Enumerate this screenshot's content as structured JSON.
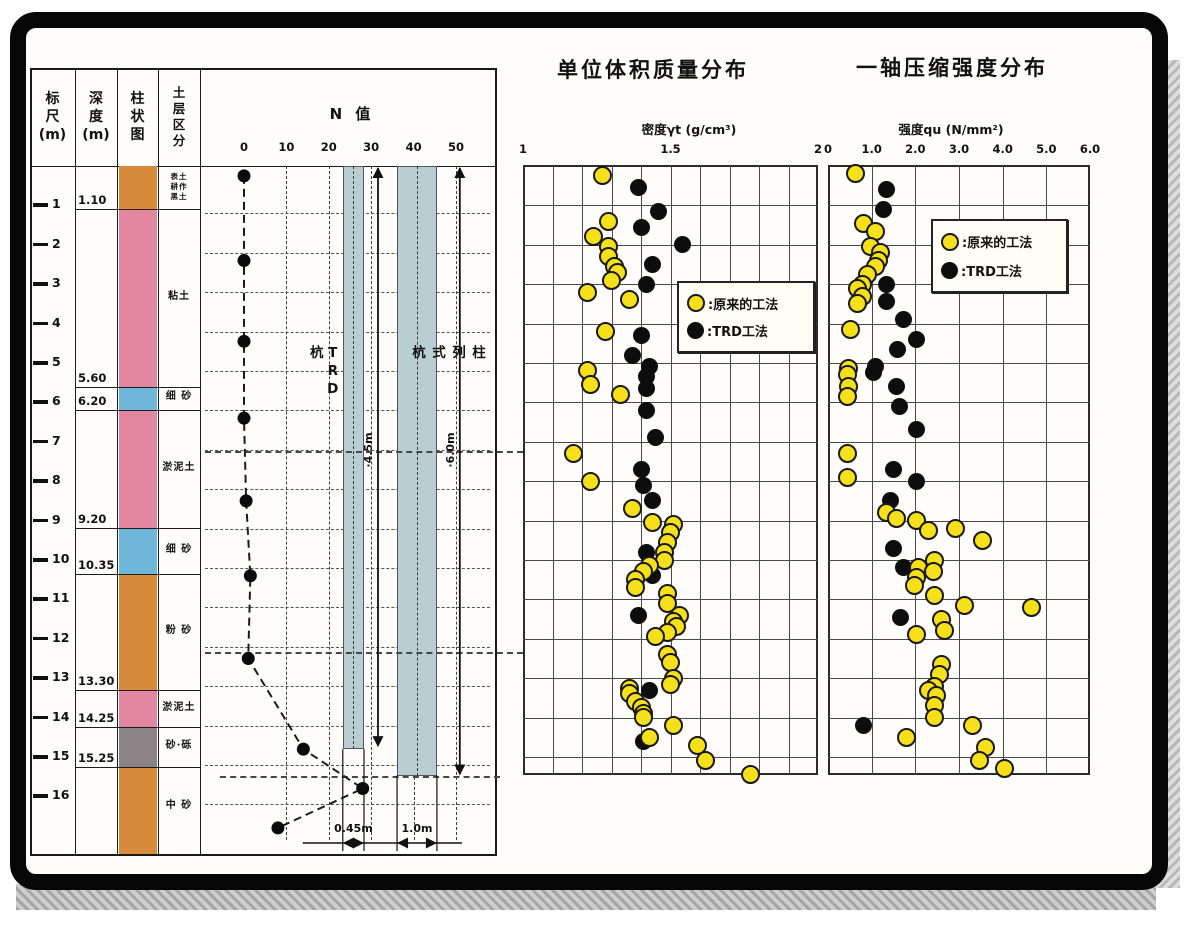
{
  "colors": {
    "bar_fill": "#b9ced3",
    "soil_orange": "#d78c3c",
    "soil_pink": "#e287a0",
    "soil_blue": "#6fb7da",
    "soil_gray": "#8b8486",
    "dot_yellow": "#f6e019",
    "dot_black": "#0d0d0d",
    "frame": "#070707"
  },
  "borehole": {
    "headers": [
      {
        "label": "标\n尺\n(m)"
      },
      {
        "label": "深\n度\n(m)"
      },
      {
        "label": "柱\n状\n图"
      },
      {
        "label": "土\n层\n区\n分"
      }
    ],
    "ruler_max": 16,
    "boundaries": [
      {
        "depth": 1.1,
        "label": "1.10"
      },
      {
        "depth": 5.6,
        "label": "5.60"
      },
      {
        "depth": 6.2,
        "label": "6.20"
      },
      {
        "depth": 9.2,
        "label": "9.20"
      },
      {
        "depth": 10.35,
        "label": "10.35"
      },
      {
        "depth": 13.3,
        "label": "13.30"
      },
      {
        "depth": 14.25,
        "label": "14.25"
      },
      {
        "depth": 15.25,
        "label": "15.25"
      }
    ],
    "layers": [
      {
        "from": 0,
        "to": 1.1,
        "color_key": "soil_orange",
        "label": "表土\n耕作\n黑土",
        "small": true
      },
      {
        "from": 1.1,
        "to": 5.6,
        "color_key": "soil_pink",
        "label": "粘土",
        "small": false
      },
      {
        "from": 5.6,
        "to": 6.2,
        "color_key": "soil_blue",
        "label": "细 砂",
        "small": false
      },
      {
        "from": 6.2,
        "to": 9.2,
        "color_key": "soil_pink",
        "label": "淤泥土",
        "small": false
      },
      {
        "from": 9.2,
        "to": 10.35,
        "color_key": "soil_blue",
        "label": "细 砂",
        "small": false
      },
      {
        "from": 10.35,
        "to": 13.3,
        "color_key": "soil_orange",
        "label": "粉 砂",
        "small": false
      },
      {
        "from": 13.3,
        "to": 14.25,
        "color_key": "soil_pink",
        "label": "淤泥土",
        "small": false
      },
      {
        "from": 14.25,
        "to": 15.25,
        "color_key": "soil_gray",
        "label": "砂·砾",
        "small": false
      },
      {
        "from": 15.25,
        "to": 17.45,
        "color_key": "soil_orange",
        "label": "中 砂",
        "small": false
      }
    ]
  },
  "n_chart": {
    "title": "N 值",
    "ticks": [
      0,
      10,
      20,
      30,
      40,
      50
    ],
    "bars": [
      {
        "label": "TRD杭",
        "from_n": 23.3,
        "to_n": 28.3,
        "bottom_depth": 14.8,
        "label_pos": "left"
      },
      {
        "label": "柱列式杭",
        "from_n": 36.1,
        "to_n": 45.5,
        "bottom_depth": 15.47,
        "label_pos": "inside"
      }
    ],
    "arrows": [
      {
        "n": 31.6,
        "bottom_depth": 14.75,
        "label": "·4.5m"
      },
      {
        "n": 50.9,
        "bottom_depth": 15.47,
        "label": "·6.0m"
      }
    ],
    "dims": [
      {
        "label": "0.45m",
        "from_n": 23.3,
        "to_n": 28.3,
        "ext_depth": 14.8
      },
      {
        "label": "1.0m",
        "from_n": 36.1,
        "to_n": 45.5,
        "ext_depth": 15.47
      }
    ],
    "connector_depths": [
      7.2,
      12.3
    ],
    "bottom_connector_depth": 15.47
  },
  "chart_data": {
    "n_curve": {
      "type": "line",
      "xlabel": "N 值",
      "x_ticks": [
        0,
        10,
        20,
        30,
        40,
        50
      ],
      "points": [
        [
          0.25,
          0
        ],
        [
          2.4,
          0
        ],
        [
          4.45,
          0
        ],
        [
          6.4,
          0
        ],
        [
          8.5,
          0.5
        ],
        [
          10.4,
          1.5
        ],
        [
          12.5,
          1.0
        ],
        [
          14.8,
          14
        ],
        [
          15.8,
          28
        ],
        [
          16.8,
          8
        ]
      ]
    },
    "scatter_charts": [
      {
        "type": "scatter",
        "title": "单位体积质量分布",
        "axis_label": "密度γt (g/cm³)",
        "range": [
          1,
          2
        ],
        "minor_step": 0.1,
        "depth_range": [
          0,
          15.5
        ],
        "ticks": [
          {
            "v": 1,
            "t": "1"
          },
          {
            "v": 1.5,
            "t": "1.5"
          },
          {
            "v": 2,
            "t": "2"
          }
        ],
        "legend": [
          {
            "marker": "yellow",
            "label": ":原来的工法"
          },
          {
            "marker": "black",
            "label": ":TRD工法"
          }
        ],
        "series": [
          {
            "name": "TRD工法",
            "marker": "black",
            "points": [
              [
                0.55,
                1.39
              ],
              [
                1.15,
                1.46
              ],
              [
                1.55,
                1.4
              ],
              [
                2.0,
                1.54
              ],
              [
                2.5,
                1.44
              ],
              [
                3.0,
                1.42
              ],
              [
                4.3,
                1.4
              ],
              [
                4.8,
                1.37
              ],
              [
                5.1,
                1.43
              ],
              [
                5.35,
                1.42
              ],
              [
                5.65,
                1.42
              ],
              [
                6.2,
                1.42
              ],
              [
                6.9,
                1.45
              ],
              [
                7.7,
                1.4
              ],
              [
                8.1,
                1.41
              ],
              [
                8.5,
                1.44
              ],
              [
                9.8,
                1.42
              ],
              [
                10.4,
                1.44
              ],
              [
                11.4,
                1.39
              ],
              [
                13.3,
                1.43
              ],
              [
                14.6,
                1.41
              ]
            ]
          },
          {
            "name": "原来的工法",
            "marker": "yellow",
            "points": [
              [
                0.25,
                1.27
              ],
              [
                1.4,
                1.29
              ],
              [
                1.8,
                1.24
              ],
              [
                2.05,
                1.29
              ],
              [
                2.3,
                1.29
              ],
              [
                2.55,
                1.31
              ],
              [
                2.7,
                1.32
              ],
              [
                2.9,
                1.3
              ],
              [
                3.2,
                1.22
              ],
              [
                3.4,
                1.36
              ],
              [
                4.2,
                1.28
              ],
              [
                5.2,
                1.22
              ],
              [
                5.55,
                1.23
              ],
              [
                5.8,
                1.33
              ],
              [
                7.3,
                1.17
              ],
              [
                8.0,
                1.23
              ],
              [
                8.7,
                1.37
              ],
              [
                9.05,
                1.44
              ],
              [
                9.1,
                1.51
              ],
              [
                9.3,
                1.5
              ],
              [
                9.55,
                1.49
              ],
              [
                9.8,
                1.48
              ],
              [
                10.0,
                1.48
              ],
              [
                10.15,
                1.43
              ],
              [
                10.3,
                1.41
              ],
              [
                10.5,
                1.38
              ],
              [
                10.7,
                1.38
              ],
              [
                10.85,
                1.49
              ],
              [
                11.1,
                1.49
              ],
              [
                11.4,
                1.53
              ],
              [
                11.55,
                1.51
              ],
              [
                11.7,
                1.52
              ],
              [
                11.85,
                1.49
              ],
              [
                11.95,
                1.45
              ],
              [
                12.4,
                1.49
              ],
              [
                12.6,
                1.5
              ],
              [
                13.0,
                1.51
              ],
              [
                13.15,
                1.5
              ],
              [
                13.25,
                1.36
              ],
              [
                13.4,
                1.36
              ],
              [
                13.6,
                1.38
              ],
              [
                13.75,
                1.4
              ],
              [
                13.9,
                1.41
              ],
              [
                14.0,
                1.41
              ],
              [
                14.2,
                1.51
              ],
              [
                14.5,
                1.43
              ],
              [
                14.7,
                1.59
              ],
              [
                15.1,
                1.62
              ],
              [
                15.45,
                1.77
              ]
            ]
          }
        ]
      },
      {
        "type": "scatter",
        "title": "一轴压缩强度分布",
        "axis_label": "强度qu (N/mm²)",
        "range": [
          0,
          6
        ],
        "minor_step": 1.0,
        "depth_range": [
          0,
          15.5
        ],
        "ticks": [
          {
            "v": 0,
            "t": "0"
          },
          {
            "v": 1,
            "t": "1.0"
          },
          {
            "v": 2,
            "t": "2.0"
          },
          {
            "v": 3,
            "t": "3.0"
          },
          {
            "v": 4,
            "t": "4.0"
          },
          {
            "v": 5,
            "t": "5.0"
          },
          {
            "v": 6,
            "t": "6.0"
          }
        ],
        "legend": [
          {
            "marker": "yellow",
            "label": ":原来的工法"
          },
          {
            "marker": "black",
            "label": ":TRD工法"
          }
        ],
        "series": [
          {
            "name": "TRD工法",
            "marker": "black",
            "points": [
              [
                0.6,
                1.33
              ],
              [
                1.1,
                1.28
              ],
              [
                3.0,
                1.33
              ],
              [
                3.45,
                1.33
              ],
              [
                3.9,
                1.74
              ],
              [
                4.4,
                2.02
              ],
              [
                4.65,
                1.6
              ],
              [
                5.1,
                1.09
              ],
              [
                5.25,
                1.05
              ],
              [
                5.6,
                1.56
              ],
              [
                6.1,
                1.63
              ],
              [
                6.7,
                2.02
              ],
              [
                7.7,
                1.51
              ],
              [
                8.0,
                2.02
              ],
              [
                8.5,
                1.44
              ],
              [
                9.7,
                1.51
              ],
              [
                10.2,
                1.72
              ],
              [
                11.45,
                1.67
              ],
              [
                14.2,
                0.81
              ]
            ]
          },
          {
            "name": "原来的工法",
            "marker": "yellow",
            "points": [
              [
                0.2,
                0.63
              ],
              [
                1.45,
                0.81
              ],
              [
                1.65,
                1.09
              ],
              [
                2.05,
                0.98
              ],
              [
                2.2,
                1.21
              ],
              [
                2.4,
                1.16
              ],
              [
                2.55,
                1.09
              ],
              [
                2.75,
                0.91
              ],
              [
                3.0,
                0.79
              ],
              [
                3.1,
                0.67
              ],
              [
                3.3,
                0.79
              ],
              [
                3.5,
                0.67
              ],
              [
                4.15,
                0.51
              ],
              [
                5.15,
                0.47
              ],
              [
                5.3,
                0.44
              ],
              [
                5.6,
                0.47
              ],
              [
                5.85,
                0.44
              ],
              [
                7.3,
                0.44
              ],
              [
                7.9,
                0.44
              ],
              [
                8.8,
                1.33
              ],
              [
                8.95,
                1.56
              ],
              [
                9.0,
                2.02
              ],
              [
                9.25,
                2.3
              ],
              [
                9.2,
                2.91
              ],
              [
                9.5,
                3.53
              ],
              [
                10.0,
                2.44
              ],
              [
                10.2,
                2.07
              ],
              [
                10.3,
                2.42
              ],
              [
                10.45,
                2.02
              ],
              [
                10.65,
                1.98
              ],
              [
                10.9,
                2.44
              ],
              [
                11.15,
                3.12
              ],
              [
                11.2,
                4.65
              ],
              [
                11.5,
                2.6
              ],
              [
                11.8,
                2.67
              ],
              [
                11.9,
                2.02
              ],
              [
                12.65,
                2.6
              ],
              [
                12.9,
                2.56
              ],
              [
                13.2,
                2.44
              ],
              [
                13.3,
                2.3
              ],
              [
                13.45,
                2.49
              ],
              [
                13.7,
                2.44
              ],
              [
                14.0,
                2.44
              ],
              [
                14.2,
                3.3
              ],
              [
                14.5,
                1.79
              ],
              [
                14.75,
                3.6
              ],
              [
                15.1,
                3.47
              ],
              [
                15.3,
                4.05
              ]
            ]
          }
        ]
      }
    ]
  }
}
